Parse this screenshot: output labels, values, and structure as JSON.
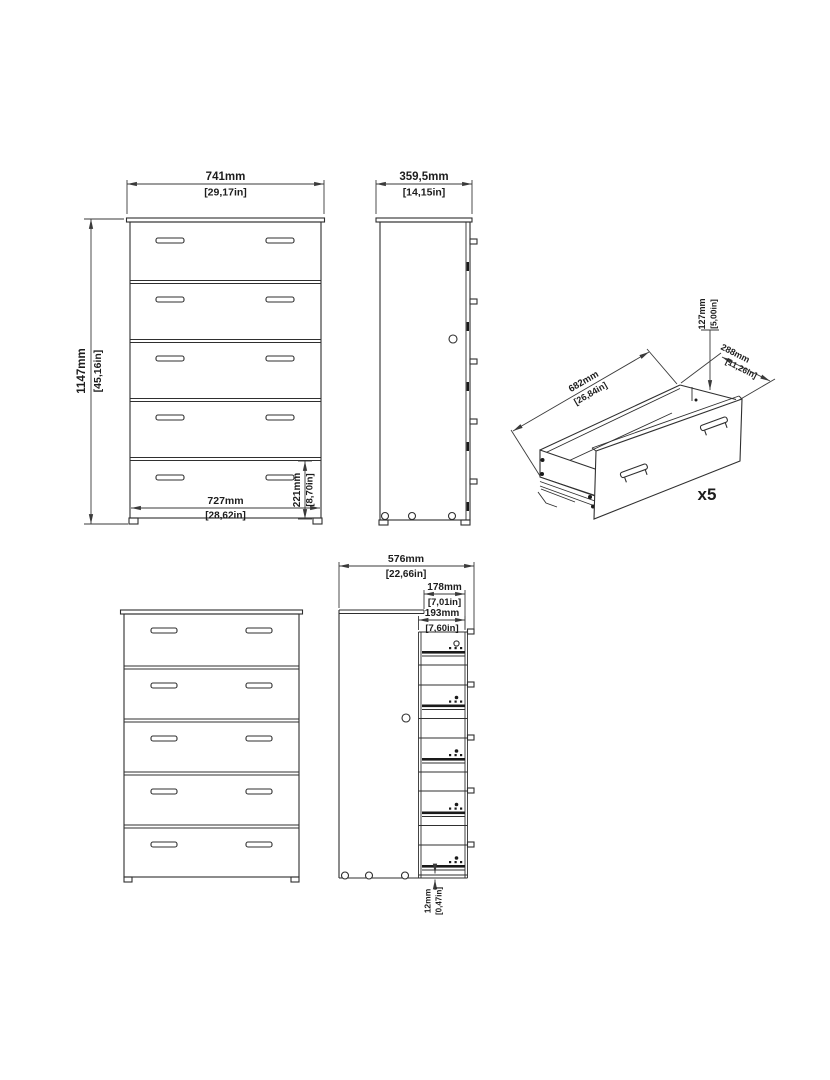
{
  "labels": {
    "front_view": {
      "width": "741mm",
      "width_in": "[29,17in]",
      "height": "1147mm",
      "height_in": "[45,16in]",
      "inner_width": "727mm",
      "inner_width_in": "[28,62in]",
      "bottom_drawer_height": "221mm",
      "bottom_drawer_height_in": "[8,70in]"
    },
    "side_view": {
      "depth": "359,5mm",
      "depth_in": "[14,15in]"
    },
    "drawer_detail": {
      "length": "682mm",
      "length_in": "[26,84in]",
      "height": "127mm",
      "height_in": "[5,00in]",
      "depth": "288mm",
      "depth_in": "[11,26in]",
      "quantity": "x5"
    },
    "side_section": {
      "total_depth": "576mm",
      "total_depth_in": "[22,66in]",
      "top_inset": "178mm",
      "top_inset_in": "[7,01in]",
      "drawer_front_depth": "193mm",
      "drawer_front_depth_in": "[7,60in]",
      "bottom_gap": "12mm",
      "bottom_gap_in": "[0,47in]"
    }
  },
  "colors": {
    "line": "#2f2f2f",
    "dimension": "#3a3a3a",
    "text": "#1d1d1d",
    "background": "#ffffff"
  }
}
